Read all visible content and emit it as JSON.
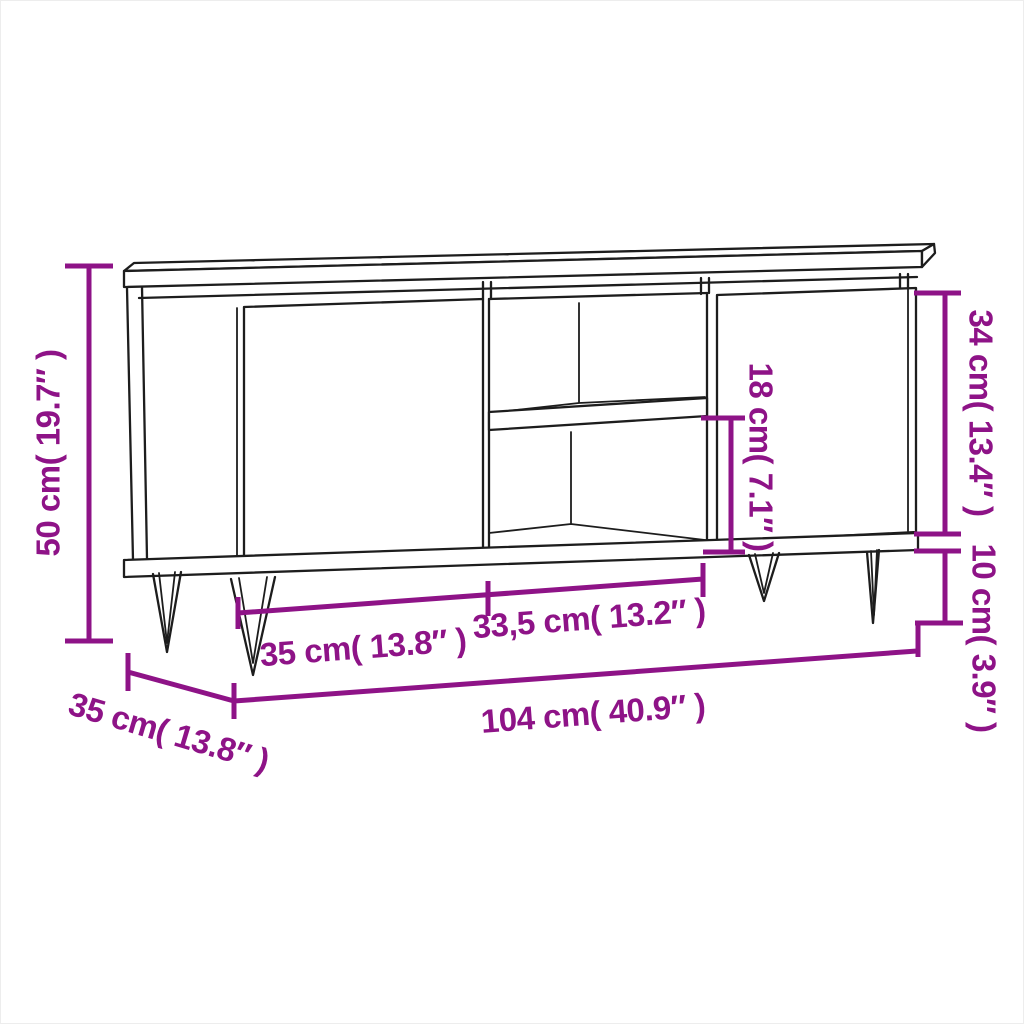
{
  "diagram": {
    "type": "furniture-dimension-diagram",
    "subject": "tv-cabinet-with-two-doors-middle-shelf-hairpin-legs",
    "background_color": "#ffffff",
    "drawing_color": "#1d1d1d",
    "dimension_color": "#8E1387",
    "dimensions": {
      "height": {
        "label": "50 cm( 19.7″ )",
        "cm": 50,
        "inch": 19.7
      },
      "door_height": {
        "label": "34 cm( 13.4″ )",
        "cm": 34,
        "inch": 13.4
      },
      "leg_height": {
        "label": "10 cm( 3.9″ )",
        "cm": 10,
        "inch": 3.9
      },
      "shelf_opening_height": {
        "label": "18 cm( 7.1″ )",
        "cm": 18,
        "inch": 7.1
      },
      "left_compartment_width": {
        "label": "35 cm( 13.8″ )",
        "cm": 35,
        "inch": 13.8
      },
      "middle_compartment_width": {
        "label": "33,5 cm( 13.2″ )",
        "cm": 33.5,
        "inch": 13.2
      },
      "total_width": {
        "label": "104 cm( 40.9″ )",
        "cm": 104,
        "inch": 40.9
      },
      "depth": {
        "label": "35 cm( 13.8″ )",
        "cm": 35,
        "inch": 13.8
      }
    }
  }
}
